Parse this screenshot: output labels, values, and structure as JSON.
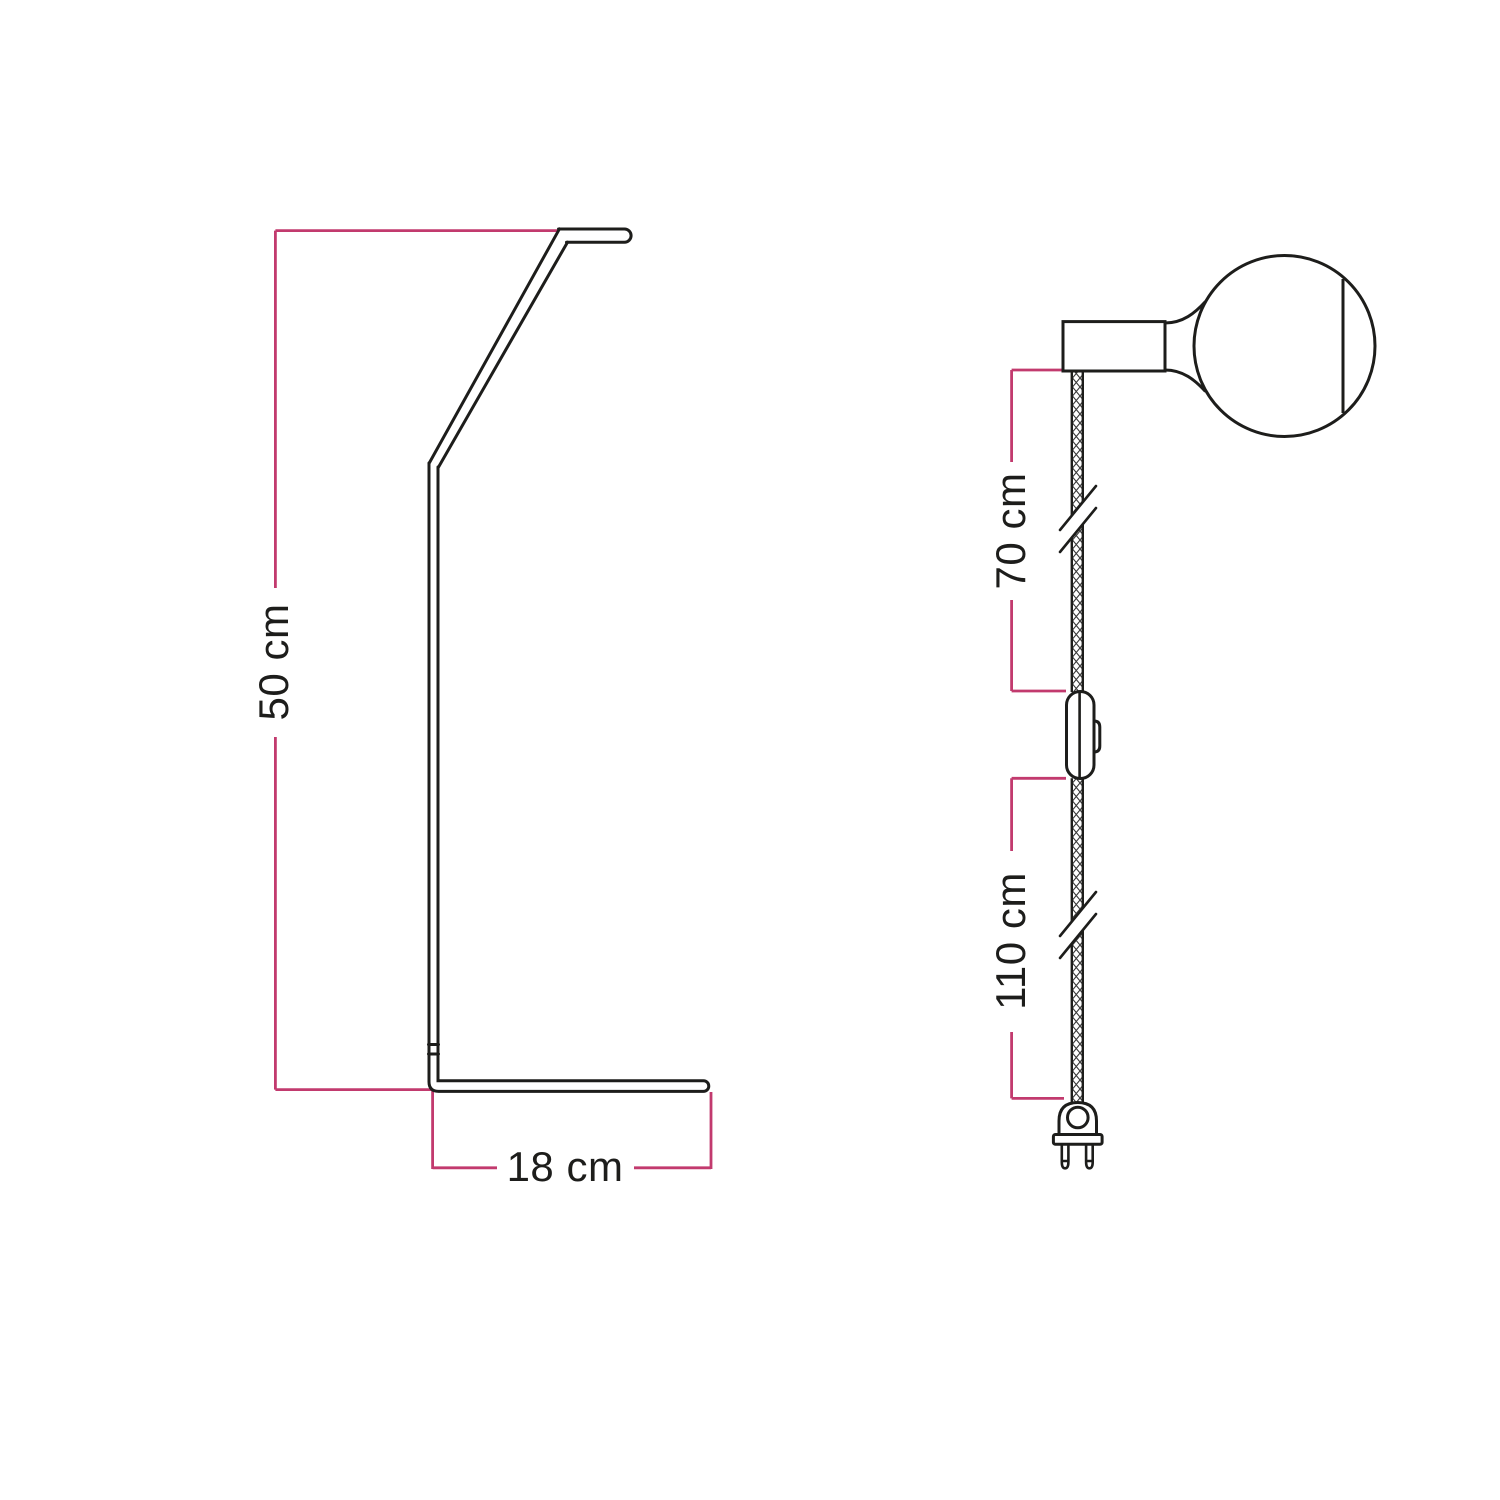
{
  "colors": {
    "dimension_line": "#c23a6e",
    "drawing_line": "#1d1d1b",
    "label_text": "#1d1d1b",
    "background": "#ffffff"
  },
  "stand_figure": {
    "height_label": "50 cm",
    "base_width_label": "18 cm"
  },
  "cord_figure": {
    "upper_cable_label": "70 cm",
    "lower_cable_label": "110 cm"
  }
}
